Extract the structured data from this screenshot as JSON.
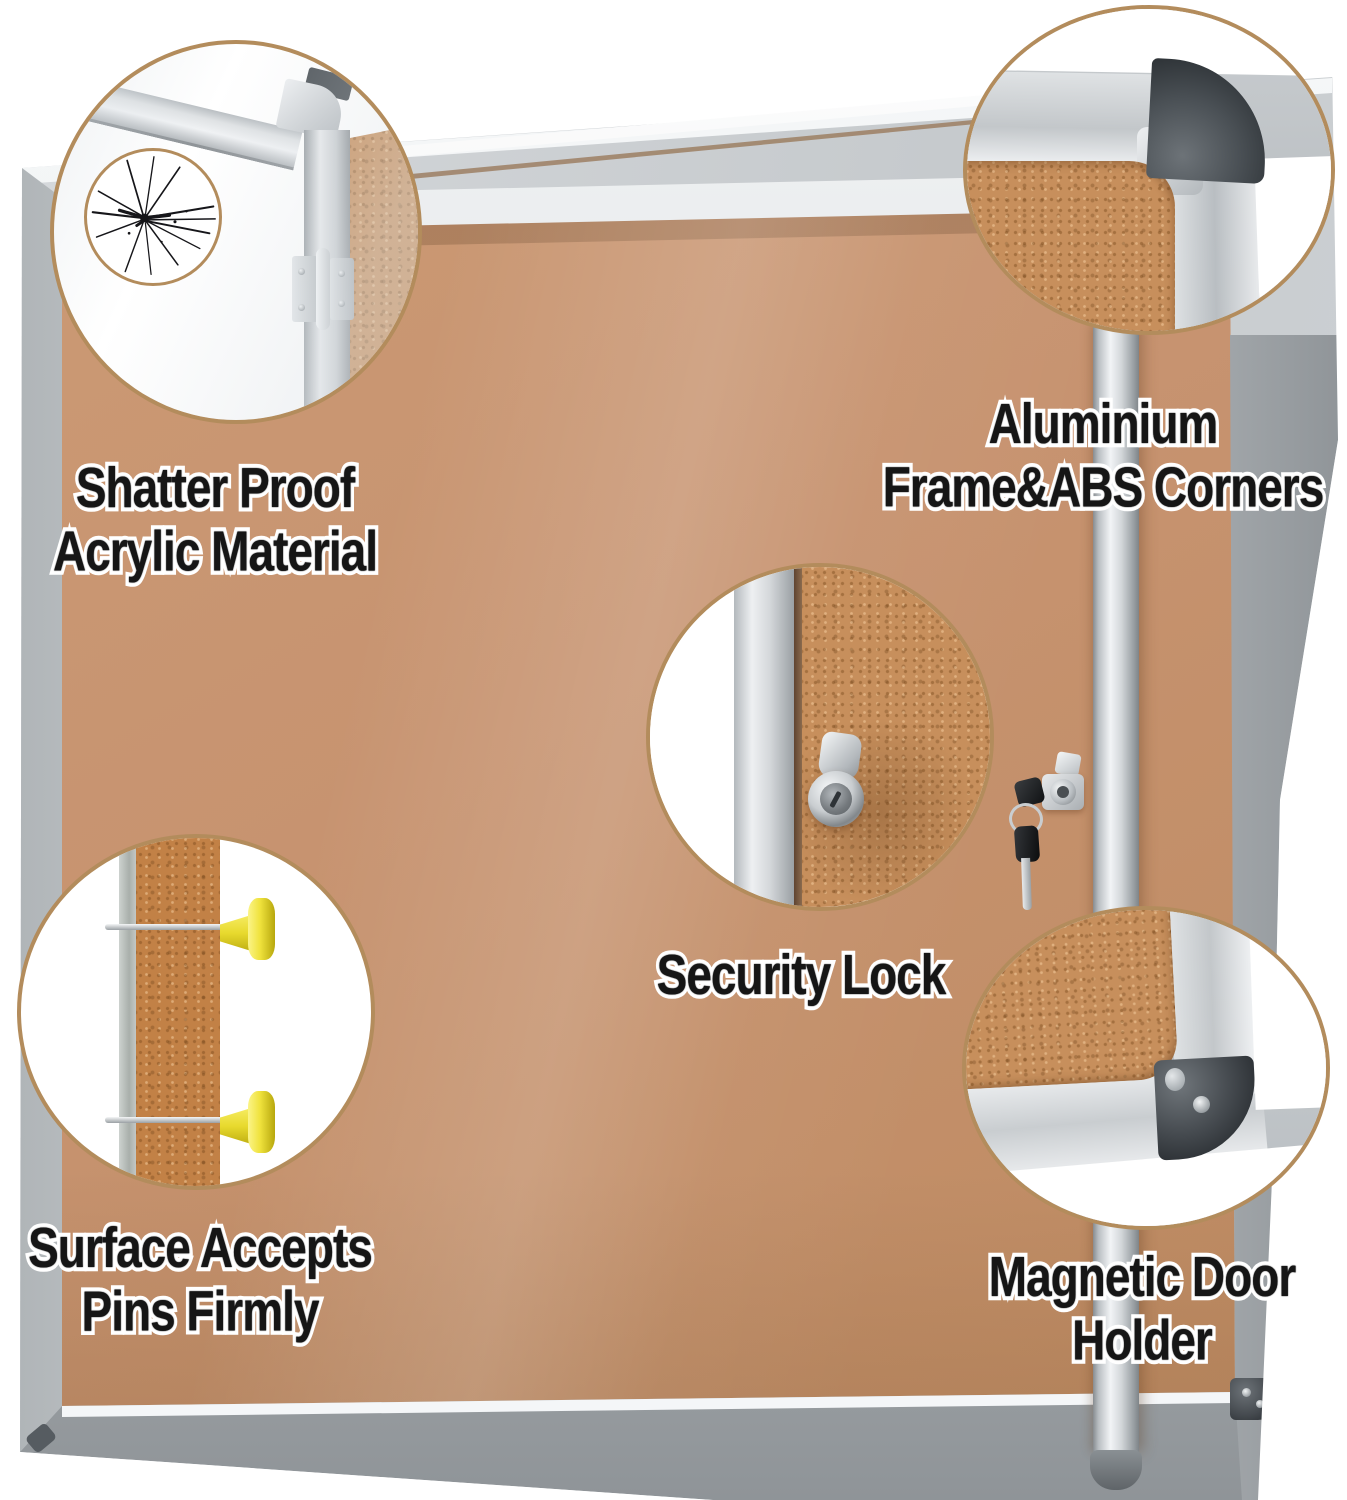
{
  "features": [
    {
      "id": "shatter-proof-acrylic",
      "line1": "Shatter Proof",
      "line2": "Acrylic Material"
    },
    {
      "id": "aluminium-frame-abs-corners",
      "line1": "Aluminium",
      "line2": "Frame&ABS Corners"
    },
    {
      "id": "security-lock",
      "line1": "Security Lock",
      "line2": ""
    },
    {
      "id": "surface-accepts-pins",
      "line1": "Surface Accepts",
      "line2": "Pins Firmly"
    },
    {
      "id": "magnetic-door-holder",
      "line1": "Magnetic Door",
      "line2": "Holder"
    }
  ],
  "colors": {
    "background": "#ffffff",
    "callout_ring": "#b38c5c",
    "cork": "#c69370",
    "cork_magnified": "#c78f5c",
    "aluminium_frame": "#d7dadd",
    "abs_corner": "#3e4347",
    "label_text": "#161616",
    "label_outline": "#ffffff",
    "pushpin_yellow": "#efe23c"
  }
}
